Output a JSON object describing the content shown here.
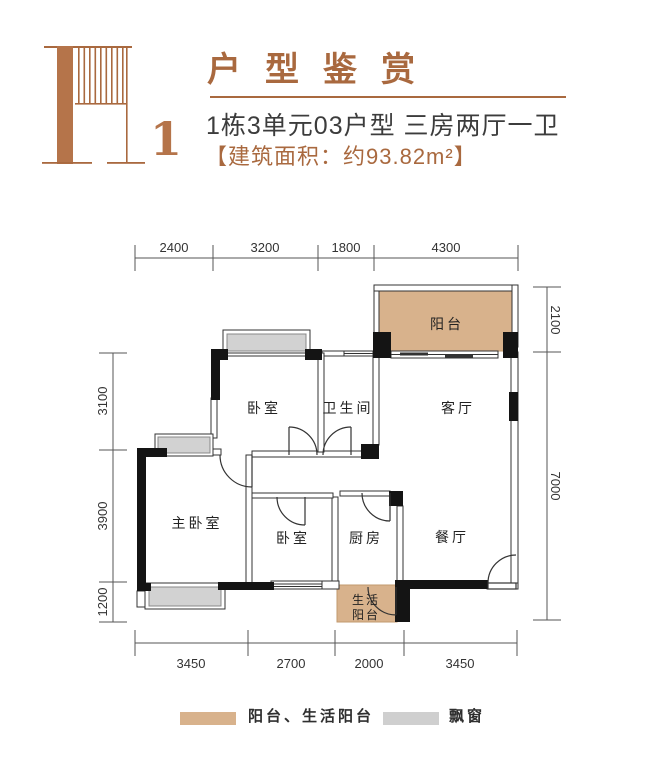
{
  "header": {
    "logo_number": "1",
    "title": "户型鉴赏",
    "subtitle": "1栋3单元03户型 三房两厅一卫",
    "area_line": "【建筑面积：约93.82m²】"
  },
  "floor_plan": {
    "rooms": {
      "balcony": "阳台",
      "bedroom_top": "卧室",
      "bathroom": "卫生间",
      "living_room": "客厅",
      "master_bedroom": "主卧室",
      "bedroom_mid": "卧室",
      "kitchen": "厨房",
      "dining_room": "餐厅",
      "service_balcony_line1": "生活",
      "service_balcony_line2": "阳台"
    },
    "dims": {
      "top": [
        "2400",
        "3200",
        "1800",
        "4300"
      ],
      "bottom": [
        "3450",
        "2700",
        "2000",
        "3450"
      ],
      "left": [
        "3100",
        "3900",
        "1200"
      ],
      "right": [
        "2100",
        "7000"
      ]
    }
  },
  "legend": {
    "items": [
      {
        "label": "阳台、生活阳台",
        "color": "#d8b28c"
      },
      {
        "label": "飘窗",
        "color": "#cfcfcf"
      }
    ]
  },
  "colors": {
    "brand_brown": "#a9693f",
    "logo_brown": "#b5744a",
    "balcony_fill": "#d8b28c",
    "bay_window_fill": "#d2d2d2",
    "wall_black": "#141414",
    "subtitle_gray": "#3c3c3c"
  }
}
